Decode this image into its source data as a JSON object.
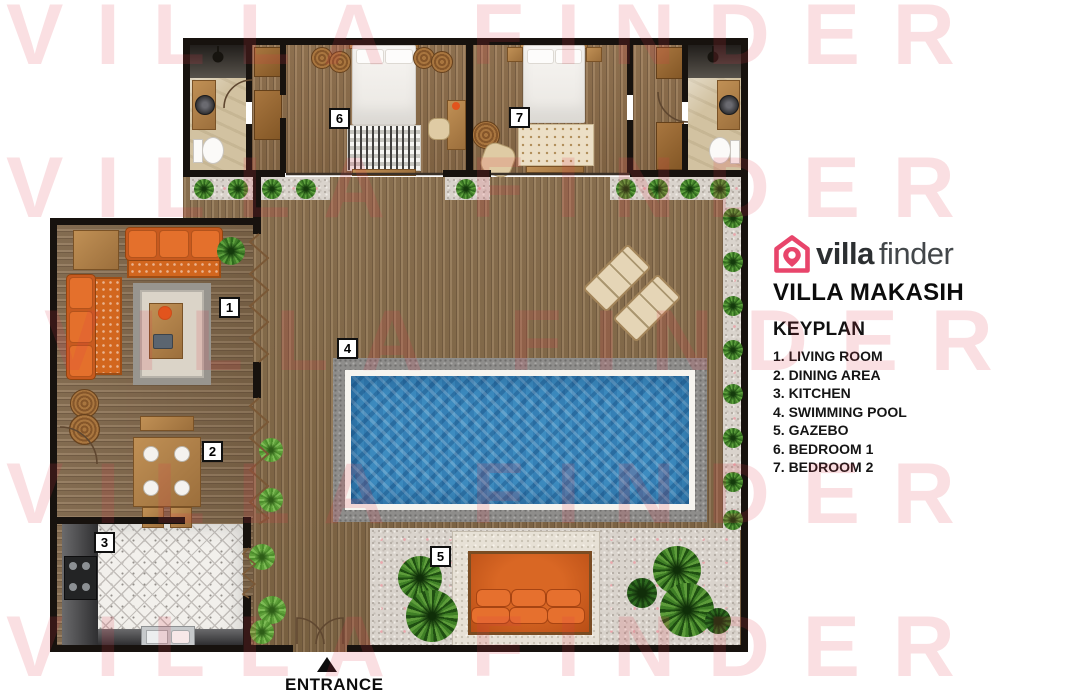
{
  "watermark": {
    "text": "VILLA FINDER",
    "color": "#e84a5f",
    "opacity": 0.16
  },
  "brand": {
    "logo_villa": "villa",
    "logo_finder": "finder",
    "accent": "#e8456b",
    "villa_name": "VILLA MAKASIH"
  },
  "keyplan": {
    "title": "KEYPLAN",
    "items": [
      "1. LIVING ROOM",
      "2. DINING AREA",
      "3. KITCHEN",
      "4. SWIMMING POOL",
      "5. GAZEBO",
      "6. BEDROOM 1",
      "7. BEDROOM 2"
    ]
  },
  "plan": {
    "entrance_label": "ENTRANCE",
    "badges": [
      "1",
      "2",
      "3",
      "4",
      "5",
      "6",
      "7"
    ]
  },
  "colors": {
    "wall": "#17120e",
    "deck_wood": "#8e714c",
    "pool_water": "#3d8cc0",
    "pool_stone": "#8e8d8b",
    "gravel": "#d9d3cc",
    "sofa_orange": "#df6c2a",
    "plant_green": "#4e9032",
    "kitchen_tile": "#f2f0ec",
    "watermark_pink": "#f6cdd0"
  }
}
